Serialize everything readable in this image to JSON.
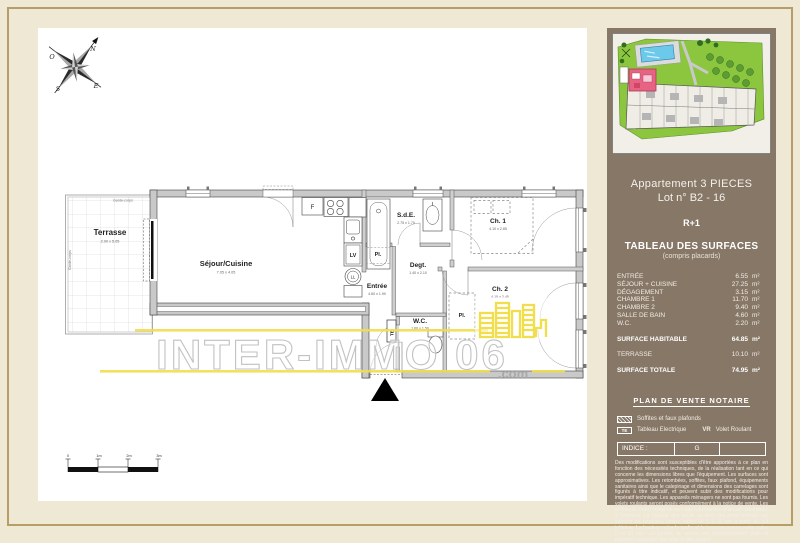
{
  "colors": {
    "paper_cream": "#efe8d5",
    "frame_tan": "#b79d67",
    "sidebar_brown": "#877767",
    "watermark_yellow": "#f1de4d",
    "watermark_gray": "#c2c2c2",
    "wall_gray": "#c9c9c9",
    "map_green": "#8cc63e",
    "pool_blue": "#6cc9e9",
    "highlight_pink": "#e86383"
  },
  "plan": {
    "compass": {
      "n": "N",
      "o": "O",
      "e": "E",
      "s": "S"
    },
    "garde_corps": "Garde-corps",
    "rooms": [
      {
        "name": "Terrasse",
        "dim": "2.00 x 5.05"
      },
      {
        "name": "Séjour/Cuisine",
        "dim": "7.05 x 4.05"
      },
      {
        "name": "Entrée",
        "dim": "4.60 x 1.90"
      },
      {
        "name": "S.d.E.",
        "dim": "2.75 x 1.70"
      },
      {
        "name": "Degt.",
        "dim": "1.40 x 2.10"
      },
      {
        "name": "Ch. 1",
        "dim": "4.10 x 2.85"
      },
      {
        "name": "Ch. 2",
        "dim": "4.15 x 2.45"
      },
      {
        "name": "W.C.",
        "dim": "1.60 x 1.50"
      },
      {
        "name": "Pl."
      },
      {
        "name": "Pl."
      }
    ],
    "fixtures": {
      "fridge": "F",
      "lv": "LV",
      "ll": "LL",
      "te": "TE"
    },
    "scale_labels": [
      "0",
      "1m",
      "2m",
      "3m"
    ]
  },
  "watermark": {
    "text": "INTER-IMMO 06",
    "suffix": ".com"
  },
  "sidebar": {
    "title_line1": "Appartement 3 PIECES",
    "title_line2": "Lot n° B2 - 16",
    "floor": "R+1",
    "table_title": "TABLEAU DES SURFACES",
    "table_subtitle": "(compris placards)",
    "unit": "m²",
    "rows": [
      {
        "label": "ENTRÉE",
        "value": "6.55"
      },
      {
        "label": "SÉJOUR + CUISINE",
        "value": "27.25"
      },
      {
        "label": "DÉGAGEMENT",
        "value": "3.15"
      },
      {
        "label": "CHAMBRE 1",
        "value": "11.70"
      },
      {
        "label": "CHAMBRE 2",
        "value": "9.40"
      },
      {
        "label": "SALLE DE BAIN",
        "value": "4.60"
      },
      {
        "label": "W.C.",
        "value": "2.20"
      }
    ],
    "totals": [
      {
        "label": "SURFACE HABITABLE",
        "value": "64.85"
      },
      {
        "label": "TERRASSE",
        "value": "10.10"
      },
      {
        "label": "SURFACE TOTALE",
        "value": "74.95"
      }
    ],
    "notary_title": "PLAN DE VENTE NOTAIRE",
    "legend": [
      {
        "swatch": "hatch",
        "label": "Soffites et faux plafonds"
      },
      {
        "swatch": "TE",
        "label": "Tableau Electrique"
      },
      {
        "swatch": "VR",
        "label": "Volet Roulant"
      }
    ],
    "indice_label": "INDICE :",
    "indice_value": "G",
    "disclaimer": "Des modifications sont susceptibles d'être apportées à ce plan en fonction des nécessités techniques, de la réalisation tant en ce qui concerne les dimensions libres que l'équipement. Les surfaces sont approximatives. Les retombées, soffites, faux plafond, équipements sanitaires ainsi que le calepinage et dimensions des carrelages sont figurés à titre indicatif, et peuvent subir des modifications pour impératif technique. Les appareils ménagers ne sont pas fournis. Les volets roulants seront posés conformément à la notice de vente. Les coffres de volet roulant ne sont pas représentés et seront débordants à l'intérieur. La hauteur des seuils au droit des porte-fenêtres sur balcons ou terrasses pourra varier de 5 à 35 cm à partir du sol intérieur. La hauteur entre le jardin et la terrasse pourra varier entre 0 et 60 cm. Les jardins ne seront pas nécessairement plats et pourront comporter des talus et des pentes."
  }
}
